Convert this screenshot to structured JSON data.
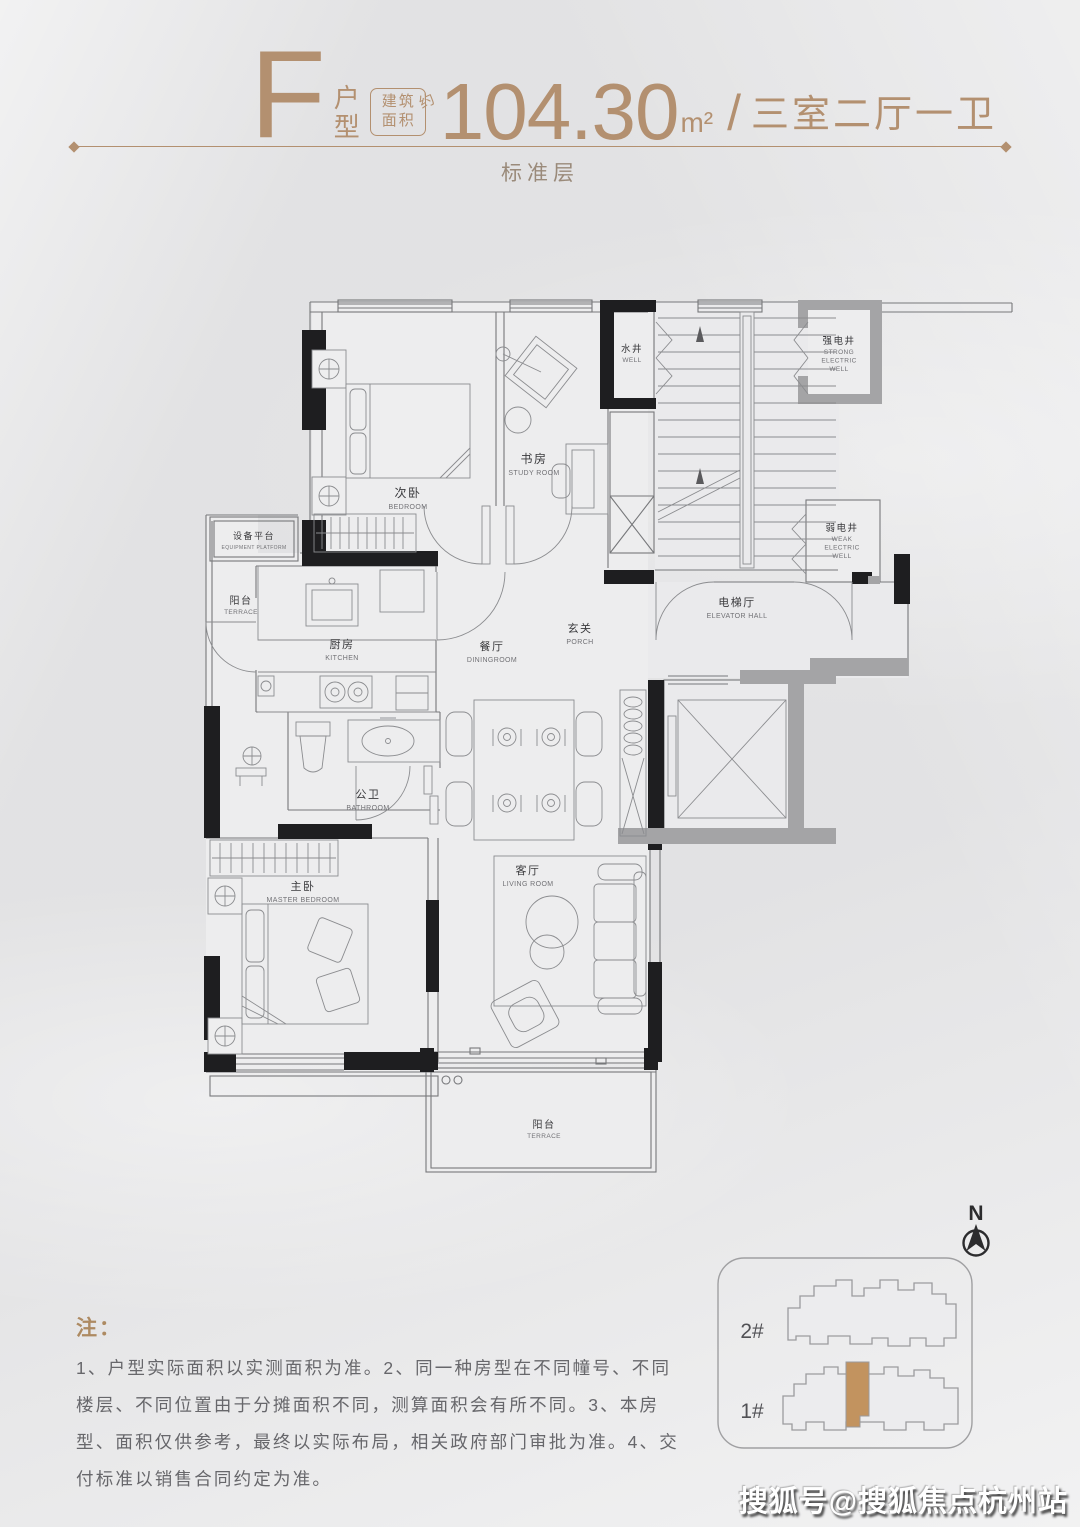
{
  "page": {
    "background": "#e9e9ea",
    "watermark": "搜狐号@搜狐焦点杭州站"
  },
  "header": {
    "type_letter": "F",
    "type_suffix": "户\n型",
    "area_box_line1": "建筑",
    "area_box_line2": "面积",
    "area_approx": "约",
    "area_value": "104.30",
    "area_unit": "m²",
    "separator": "/",
    "layout_label": "三室二厅一卫",
    "floor_label": "标准层",
    "accent_color": "#b39070"
  },
  "plan": {
    "rooms": [
      {
        "id": "bedroom",
        "zh": "次卧",
        "en": "BEDROOM",
        "x": 408,
        "y": 497,
        "zs": 12,
        "es": 7
      },
      {
        "id": "study-room",
        "zh": "书房",
        "en": "STUDY ROOM",
        "x": 534,
        "y": 463,
        "zs": 12,
        "es": 7
      },
      {
        "id": "well",
        "zh": "水井",
        "en": "WELL",
        "x": 632,
        "y": 352,
        "zs": 9.5,
        "es": 6.5
      },
      {
        "id": "strong-electric-well",
        "zh": "强电井",
        "en": "STRONG\nELECTRIC\nWELL",
        "x": 839,
        "y": 344,
        "zs": 9.5,
        "es": 6.5
      },
      {
        "id": "weak-electric-well",
        "zh": "弱电井",
        "en": "WEAK\nELECTRIC\nWELL",
        "x": 842,
        "y": 531,
        "zs": 9.5,
        "es": 6.5
      },
      {
        "id": "elevator-hall",
        "zh": "电梯厅",
        "en": "ELEVATOR HALL",
        "x": 737,
        "y": 606,
        "zs": 11,
        "es": 7
      },
      {
        "id": "equipment-platform",
        "zh": "设备平台",
        "en": "EQUIPMENT PLATFORM",
        "x": 254,
        "y": 539,
        "zs": 9,
        "es": 5
      },
      {
        "id": "terrace-west",
        "zh": "阳台",
        "en": "TERRACE",
        "x": 241,
        "y": 604,
        "zs": 10,
        "es": 6.5
      },
      {
        "id": "kitchen",
        "zh": "厨房",
        "en": "KITCHEN",
        "x": 342,
        "y": 648,
        "zs": 11,
        "es": 7
      },
      {
        "id": "dining-room",
        "zh": "餐厅",
        "en": "DININGROOM",
        "x": 492,
        "y": 650,
        "zs": 11,
        "es": 7
      },
      {
        "id": "porch",
        "zh": "玄关",
        "en": "PORCH",
        "x": 580,
        "y": 632,
        "zs": 11,
        "es": 7
      },
      {
        "id": "bathroom",
        "zh": "公卫",
        "en": "BATHROOM",
        "x": 368,
        "y": 798,
        "zs": 11,
        "es": 7
      },
      {
        "id": "master-bedroom",
        "zh": "主卧",
        "en": "MASTER BEDROOM",
        "x": 303,
        "y": 890,
        "zs": 11,
        "es": 7
      },
      {
        "id": "living-room",
        "zh": "客厅",
        "en": "LIVING ROOM",
        "x": 528,
        "y": 874,
        "zs": 11,
        "es": 7
      },
      {
        "id": "terrace-south",
        "zh": "阳台",
        "en": "TERRACE",
        "x": 544,
        "y": 1128,
        "zs": 10,
        "es": 6.5
      }
    ]
  },
  "notes": {
    "title": "注：",
    "lines": [
      "1、户型实际面积以实测面积为准。2、同一种房型在不同幢号、不同",
      "楼层、不同位置由于分摊面积不同，测算面积会有所不同。3、本房",
      "型、面积仅供参考，最终以实际布局，相关政府部门审批为准。4、交",
      "付标准以销售合同约定为准。"
    ]
  },
  "compass": {
    "label": "N"
  },
  "keyplan": {
    "buildings": [
      {
        "label": "2#"
      },
      {
        "label": "1#"
      }
    ],
    "highlight_color": "#c2935f"
  }
}
